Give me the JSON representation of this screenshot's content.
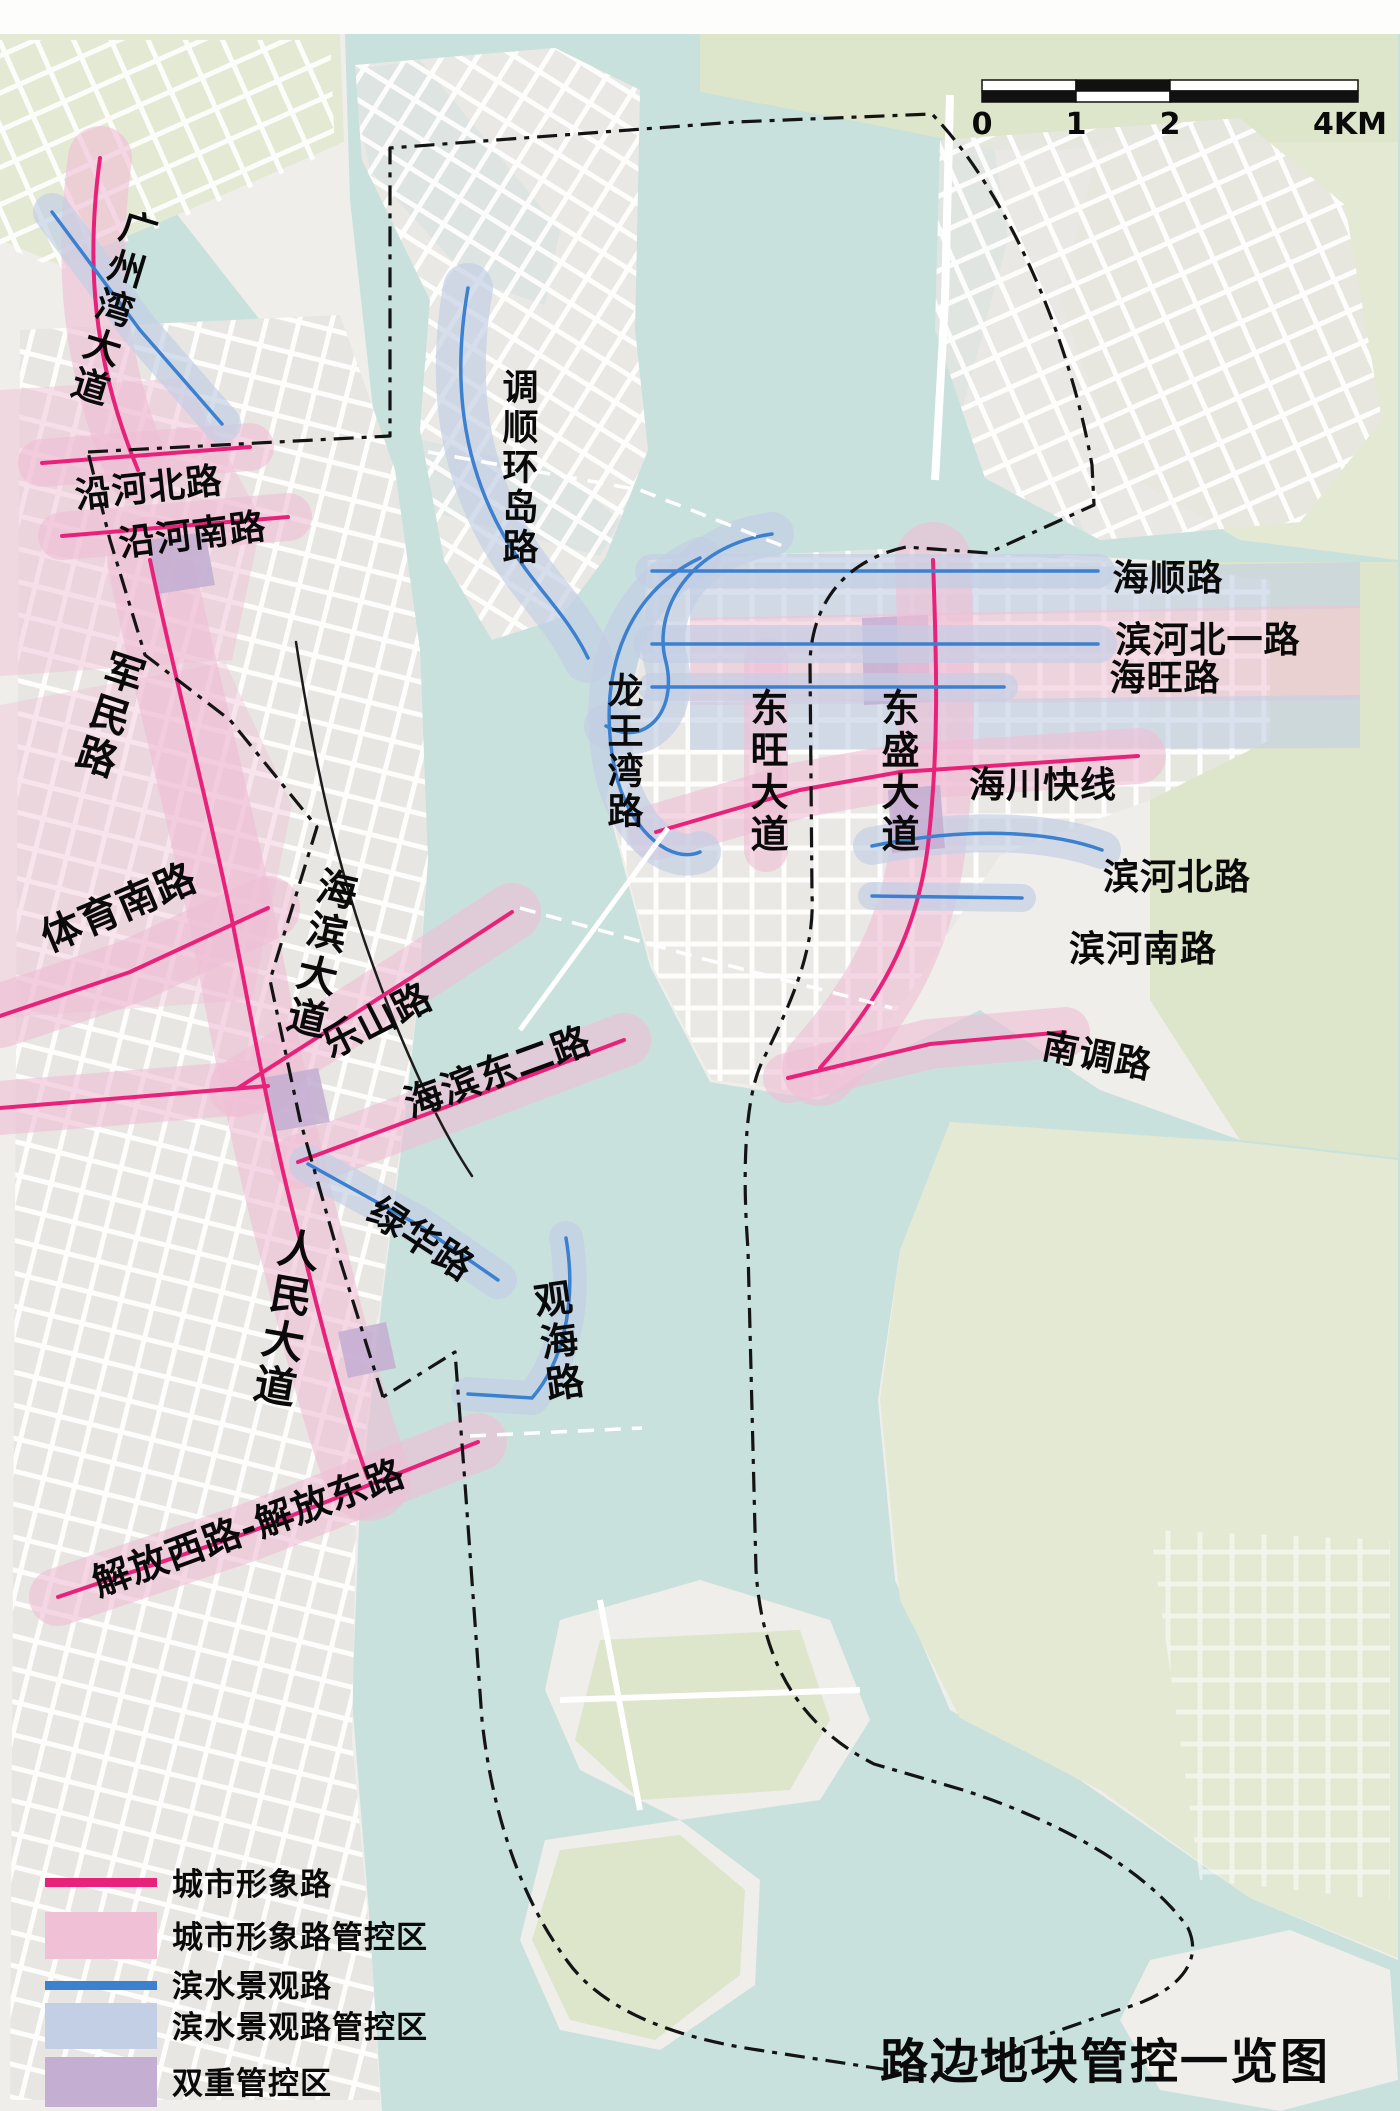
{
  "map": {
    "title": "路边地块管控一览图",
    "scale_bar": {
      "ticks": [
        "0",
        "1",
        "2",
        "4KM"
      ]
    },
    "legend": [
      {
        "type": "line",
        "label": "城市形象路"
      },
      {
        "type": "fill",
        "label": "城市形象路管控区"
      },
      {
        "type": "line",
        "label": "滨水景观路"
      },
      {
        "type": "fill",
        "label": "滨水景观路管控区"
      },
      {
        "type": "fill",
        "label": "双重管控区"
      }
    ],
    "road_labels": {
      "guangzhouwan": "广州湾大道",
      "yanhebei": "沿河北路",
      "yanhenan": "沿河南路",
      "junmin": "军民路",
      "tiyunan": "体育南路",
      "haibin": "海滨大道",
      "leshan": "乐山路",
      "haibindonger": "海滨东二路",
      "lvhua": "绿华路",
      "renmin": "人民大道",
      "guanhai": "观海路",
      "jiefang": "解放西路-解放东路",
      "diaoshun": "调顺环岛路",
      "longwangwan": "龙王湾路",
      "dongwang": "东旺大道",
      "dongsheng": "东盛大道",
      "haishun": "海顺路",
      "binhebeiyi": "滨河北一路",
      "haiwang": "海旺路",
      "haichuan": "海川快线",
      "binhebei": "滨河北路",
      "binhenan": "滨河南路",
      "nandiao": "南调路"
    }
  },
  "colors": {
    "city_image_road": "#e8217a",
    "city_image_zone": "#f0c1d6",
    "waterfront_road": "#3c80d0",
    "waterfront_zone": "#c2cfe5",
    "dual_zone": "#c4aed2",
    "water": "#c9e1dd",
    "boundary": "#141414"
  }
}
